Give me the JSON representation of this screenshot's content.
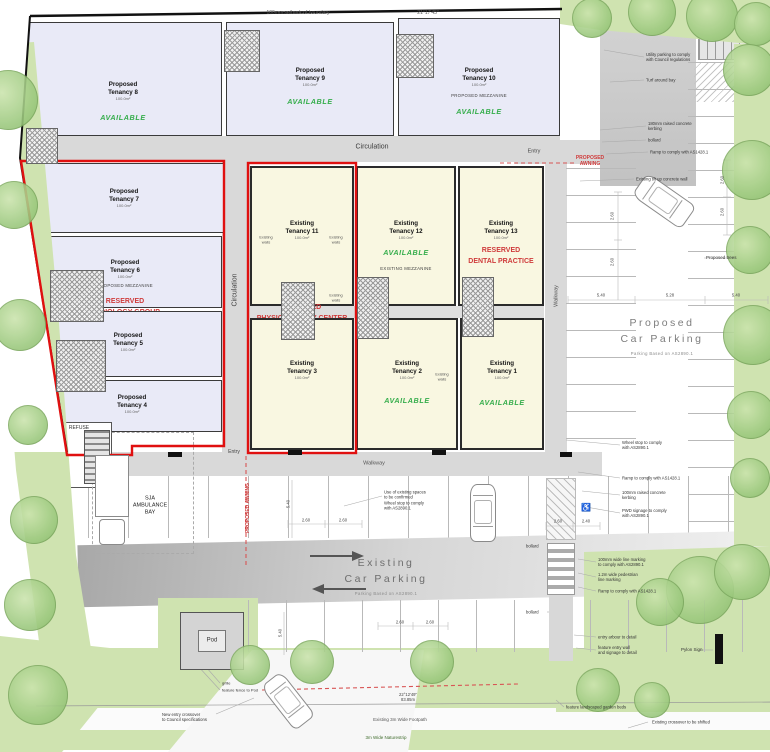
{
  "colors": {
    "proposed_room": "#e9eaf7",
    "existing_room": "#f9f7e1",
    "outline_red": "#e01010",
    "available_green": "#35ad4b",
    "reserved_red": "#cf3b3b",
    "landscape_green": "#cfe3b0"
  },
  "parking": {
    "existing": {
      "title": "Existing\nCar Parking",
      "subtitle": "Parking Based on AS2890.1"
    },
    "proposed": {
      "title": "Proposed\nCar Parking",
      "subtitle": "Parking Based on AS2890.1"
    }
  },
  "rooms": [
    {
      "id": "t8",
      "type": "proposed",
      "name": "Proposed\nTenancy 8",
      "area": "100.0m²",
      "status": "AVAILABLE",
      "box": [
        24,
        22,
        198,
        114
      ],
      "ty": {
        "name": 58,
        "area": 73,
        "status": 90
      }
    },
    {
      "id": "t9",
      "type": "proposed",
      "name": "Proposed\nTenancy 9",
      "area": "100.0m²",
      "status": "AVAILABLE",
      "box": [
        226,
        22,
        168,
        114
      ],
      "ty": {
        "name": 44,
        "area": 59,
        "status": 74
      }
    },
    {
      "id": "t10",
      "type": "proposed",
      "name": "Proposed\nTenancy 10",
      "area": "100.0m²",
      "note": "PROPOSED MEZZANINE",
      "status": "AVAILABLE",
      "box": [
        398,
        18,
        162,
        118
      ],
      "ty": {
        "name": 48,
        "area": 63,
        "note": 74,
        "status": 88
      }
    },
    {
      "id": "t7",
      "type": "proposed",
      "name": "Proposed\nTenancy 7",
      "area": "100.0m²",
      "box": [
        24,
        163,
        200,
        70
      ],
      "ty": {
        "name": 24,
        "area": 39
      }
    },
    {
      "id": "t6",
      "type": "proposed",
      "name": "Proposed\nTenancy 6",
      "area": "100.0m²",
      "note": "PROPOSED MEZZANINE",
      "reserved": "RESERVED\nRADIOLOGY GROUP",
      "box": [
        28,
        236,
        194,
        72
      ],
      "ty": {
        "name": 22,
        "area": 37,
        "note": 46,
        "reserved": 60
      }
    },
    {
      "id": "t5",
      "type": "proposed",
      "name": "Proposed\nTenancy 5",
      "area": "100.0m²",
      "box": [
        34,
        311,
        188,
        66
      ],
      "ty": {
        "name": 20,
        "area": 35
      }
    },
    {
      "id": "t4",
      "type": "proposed",
      "name": "Proposed\nTenancy 4",
      "area": "100.0m²",
      "box": [
        42,
        380,
        180,
        52
      ],
      "ty": {
        "name": 13,
        "area": 28
      }
    },
    {
      "id": "t11",
      "type": "existing",
      "name": "Existing\nTenancy 11",
      "area": "100.0m²",
      "reserved": "RESERVED\nPHYSIOTHERAPY CENTER",
      "box": [
        250,
        166,
        104,
        140
      ],
      "ty": {
        "name": 52,
        "area": 67,
        "reserved": 135
      }
    },
    {
      "id": "t12",
      "type": "existing",
      "name": "Existing\nTenancy 12",
      "area": "100.0m²",
      "status": "AVAILABLE",
      "note": "EXISTING MEZZANINE",
      "box": [
        356,
        166,
        100,
        140
      ],
      "ty": {
        "name": 52,
        "area": 67,
        "status": 80,
        "note": 98
      }
    },
    {
      "id": "t13",
      "type": "existing",
      "name": "Existing\nTenancy 13",
      "area": "100.0m²",
      "reserved": "RESERVED\nDENTAL PRACTICE",
      "box": [
        458,
        166,
        86,
        140
      ],
      "ty": {
        "name": 52,
        "area": 67,
        "reserved": 78
      }
    },
    {
      "id": "t3",
      "type": "existing",
      "name": "Existing\nTenancy 3",
      "area": "100.0m²",
      "box": [
        250,
        318,
        104,
        132
      ],
      "ty": {
        "name": 40,
        "area": 55
      }
    },
    {
      "id": "t2",
      "type": "existing",
      "name": "Existing\nTenancy 2",
      "area": "100.0m²",
      "status": "AVAILABLE",
      "box": [
        356,
        318,
        102,
        132
      ],
      "ty": {
        "name": 40,
        "area": 55,
        "status": 76
      }
    },
    {
      "id": "t1",
      "type": "existing",
      "name": "Existing\nTenancy 1",
      "area": "100.0m²",
      "status": "AVAILABLE",
      "box": [
        460,
        318,
        84,
        132
      ],
      "ty": {
        "name": 40,
        "area": 55,
        "status": 78
      }
    }
  ],
  "annotations": [
    {
      "id": "setback-note",
      "t": "100mm setback of boundary",
      "x": 298,
      "y": 13,
      "s": 5,
      "c": "#555"
    },
    {
      "id": "bearing-top",
      "t": "21°17'45\"",
      "x": 428,
      "y": 13,
      "s": 5,
      "c": "#555"
    },
    {
      "id": "circulation-top",
      "t": "Circulation",
      "x": 372,
      "y": 148,
      "s": 7,
      "c": "#3c3c3c"
    },
    {
      "id": "circulation-left",
      "t": "Circulation",
      "x": 236,
      "y": 290,
      "s": 7,
      "c": "#3c3c3c",
      "rot": -90
    },
    {
      "id": "walkway-right",
      "t": "Walkway",
      "x": 557,
      "y": 296,
      "s": 5.5,
      "c": "#555",
      "rot": -90
    },
    {
      "id": "walkway-bottom",
      "t": "Walkway",
      "x": 374,
      "y": 464,
      "s": 5.5,
      "c": "#555"
    },
    {
      "id": "entry-top",
      "t": "Entry",
      "x": 534,
      "y": 152,
      "s": 5.5,
      "c": "#444"
    },
    {
      "id": "entry-bottom",
      "t": "Entry",
      "x": 234,
      "y": 452,
      "s": 5,
      "c": "#444"
    },
    {
      "id": "proposed-awning-right",
      "t": "PROPOSED\nAWNING",
      "x": 590,
      "y": 161,
      "s": 5,
      "c": "#cf3b3b",
      "b": 1
    },
    {
      "id": "proposed-awning-mid",
      "t": "PROPOSED AWNING",
      "x": 248,
      "y": 508,
      "s": 5,
      "c": "#cf3b3b",
      "rot": -90,
      "b": 1
    },
    {
      "id": "ambulance-bay-label",
      "t": "SJA\nAMBULANCE\nBAY",
      "x": 150,
      "y": 506,
      "s": 5.5,
      "c": "#222"
    },
    {
      "id": "refuse-label",
      "t": "REFUSE",
      "x": 79,
      "y": 428,
      "s": 5,
      "c": "#333"
    },
    {
      "id": "existing-spaces-note",
      "t": "Use of existing spaces\nto be confirmed\nWheel stop to comply\nwith AS2890.1",
      "x": 384,
      "y": 500,
      "s": 4.2,
      "a": "l"
    },
    {
      "id": "proposed-trees-note",
      "t": "Proposed trees",
      "x": 706,
      "y": 258,
      "s": 4.5,
      "a": "l"
    },
    {
      "id": "utility-parking-note",
      "t": "Utility parking to comply\nwith Council regulations",
      "x": 646,
      "y": 57,
      "s": 4.2,
      "a": "l"
    },
    {
      "id": "turf-note",
      "t": "Turf around bay",
      "x": 646,
      "y": 80,
      "s": 4.2,
      "a": "l"
    },
    {
      "id": "kerbing-note-1",
      "t": "180mm raised concrete\nkerbing",
      "x": 648,
      "y": 126,
      "s": 4.2,
      "a": "l"
    },
    {
      "id": "bollard-note-1",
      "t": "bollard",
      "x": 648,
      "y": 140,
      "s": 4.2,
      "a": "l"
    },
    {
      "id": "ramp-note-1",
      "t": "Ramp to comply with AS1428.1",
      "x": 650,
      "y": 152,
      "s": 4.2,
      "a": "l"
    },
    {
      "id": "tiltup-wall-note",
      "t": "Existing tilt up concrete wall",
      "x": 636,
      "y": 179,
      "s": 4.2,
      "a": "l"
    },
    {
      "id": "wheelstop-note",
      "t": "Wheel stop to comply\nwith AS2890.1",
      "x": 622,
      "y": 445,
      "s": 4.2,
      "a": "l"
    },
    {
      "id": "ramp-note-2",
      "t": "Ramp to comply with AS1428.1",
      "x": 622,
      "y": 478,
      "s": 4.2,
      "a": "l"
    },
    {
      "id": "kerbing-note-2",
      "t": "100mm raised concrete\nkerbing",
      "x": 622,
      "y": 495,
      "s": 4.2,
      "a": "l"
    },
    {
      "id": "pwd-signage-note",
      "t": "PWD signage to comply\nwith AS2890.1",
      "x": 622,
      "y": 513,
      "s": 4.2,
      "a": "l"
    },
    {
      "id": "line-marking-note",
      "t": "100mm wide line marking\nto comply with AS2890.1",
      "x": 598,
      "y": 562,
      "s": 4.2,
      "a": "l"
    },
    {
      "id": "pedestrian-marking-note",
      "t": "1.2m wide pedestrian\nline marking",
      "x": 598,
      "y": 577,
      "s": 4.2,
      "a": "l"
    },
    {
      "id": "ramp-note-3",
      "t": "Ramp to comply with AS1428.1",
      "x": 598,
      "y": 591,
      "s": 4.2,
      "a": "l"
    },
    {
      "id": "bollard-note-2",
      "t": "bollard",
      "x": 526,
      "y": 546,
      "s": 4.2,
      "a": "l"
    },
    {
      "id": "bollard-note-3",
      "t": "bollard",
      "x": 526,
      "y": 612,
      "s": 4.2,
      "a": "l"
    },
    {
      "id": "entry-arbour-note",
      "t": "entry arbour to detail",
      "x": 598,
      "y": 637,
      "s": 4.2,
      "a": "l"
    },
    {
      "id": "entry-wall-note",
      "t": "feature entry wall\nand signage to detail",
      "x": 598,
      "y": 650,
      "s": 4.2,
      "a": "l"
    },
    {
      "id": "pylon-sign-label",
      "t": "Pylon Sign",
      "x": 681,
      "y": 650,
      "s": 4.5,
      "a": "l"
    },
    {
      "id": "garden-beds-note",
      "t": "feature landscaped garden beds",
      "x": 566,
      "y": 707,
      "s": 4.2,
      "a": "l"
    },
    {
      "id": "crossover-shift-note",
      "t": "Existing crossover to be shifted",
      "x": 652,
      "y": 722,
      "s": 4.2,
      "a": "l"
    },
    {
      "id": "pod-label",
      "t": "Pod",
      "x": 212,
      "y": 641,
      "s": 6,
      "c": "#333"
    },
    {
      "id": "grille-label",
      "t": "grille",
      "x": 222,
      "y": 683,
      "s": 4,
      "a": "l"
    },
    {
      "id": "pod-fence-label",
      "t": "feature fence to Pod",
      "x": 222,
      "y": 690,
      "s": 4,
      "a": "l"
    },
    {
      "id": "bearing-bottom",
      "t": "22°12'49\"\n83.85m",
      "x": 408,
      "y": 697,
      "s": 4.2,
      "c": "#444"
    },
    {
      "id": "footpath-label",
      "t": "Existing 3m Wide Footpath",
      "x": 400,
      "y": 720,
      "s": 4.5,
      "c": "#555"
    },
    {
      "id": "naturestrip-label",
      "t": "3m Wide Naturestrip",
      "x": 386,
      "y": 738,
      "s": 4.5,
      "c": "#3f6b2c"
    },
    {
      "id": "new-crossover-note",
      "t": "New entry crossover\nto Council specifications",
      "x": 162,
      "y": 717,
      "s": 4.2,
      "a": "l"
    },
    {
      "id": "existing-walls-1",
      "t": "Existing\nwalls",
      "x": 266,
      "y": 240,
      "s": 3.8,
      "c": "#555"
    },
    {
      "id": "existing-walls-2",
      "t": "Existing\nwalls",
      "x": 336,
      "y": 240,
      "s": 3.8,
      "c": "#555"
    },
    {
      "id": "existing-walls-3",
      "t": "Existing\nwalls",
      "x": 336,
      "y": 298,
      "s": 3.8,
      "c": "#555"
    },
    {
      "id": "existing-walls-4",
      "t": "Existing\nwalls",
      "x": 442,
      "y": 377,
      "s": 3.8,
      "c": "#555"
    },
    {
      "id": "wheelchair-symbol",
      "t": "♿",
      "x": 586,
      "y": 508,
      "s": 8,
      "c": "#777"
    },
    {
      "id": "dim-1",
      "t": "2.60",
      "x": 306,
      "y": 520,
      "s": 4.2,
      "c": "#444"
    },
    {
      "id": "dim-2",
      "t": "2.60",
      "x": 343,
      "y": 520,
      "s": 4.2,
      "c": "#444"
    },
    {
      "id": "dim-3",
      "t": "2.60",
      "x": 558,
      "y": 521,
      "s": 4.2,
      "c": "#444"
    },
    {
      "id": "dim-4",
      "t": "2.40",
      "x": 586,
      "y": 521,
      "s": 4.2,
      "c": "#444"
    },
    {
      "id": "dim-5",
      "t": "2.60",
      "x": 400,
      "y": 622,
      "s": 4.2,
      "c": "#444"
    },
    {
      "id": "dim-6",
      "t": "2.60",
      "x": 430,
      "y": 622,
      "s": 4.2,
      "c": "#444"
    },
    {
      "id": "dim-7",
      "t": "5.40",
      "x": 601,
      "y": 295,
      "s": 4.2,
      "c": "#444"
    },
    {
      "id": "dim-8",
      "t": "5.28",
      "x": 670,
      "y": 295,
      "s": 4.2,
      "c": "#444"
    },
    {
      "id": "dim-9",
      "t": "5.40",
      "x": 736,
      "y": 295,
      "s": 4.2,
      "c": "#444"
    },
    {
      "id": "dim-10",
      "t": "2.60",
      "x": 612,
      "y": 216,
      "s": 4.2,
      "c": "#444",
      "rot": -90
    },
    {
      "id": "dim-11",
      "t": "2.60",
      "x": 612,
      "y": 262,
      "s": 4.2,
      "c": "#444",
      "rot": -90
    },
    {
      "id": "dim-12",
      "t": "2.60",
      "x": 722,
      "y": 180,
      "s": 4.2,
      "c": "#444",
      "rot": -90
    },
    {
      "id": "dim-13",
      "t": "2.60",
      "x": 722,
      "y": 212,
      "s": 4.2,
      "c": "#444",
      "rot": -90
    },
    {
      "id": "dim-14",
      "t": "5.40",
      "x": 288,
      "y": 504,
      "s": 4.2,
      "c": "#444",
      "rot": -90
    },
    {
      "id": "dim-15",
      "t": "5.40",
      "x": 280,
      "y": 633,
      "s": 4.2,
      "c": "#444",
      "rot": -90
    }
  ],
  "trees": [
    [
      8,
      100,
      30
    ],
    [
      14,
      205,
      24
    ],
    [
      20,
      325,
      26
    ],
    [
      28,
      425,
      20
    ],
    [
      34,
      520,
      24
    ],
    [
      30,
      605,
      26
    ],
    [
      38,
      695,
      30
    ],
    [
      592,
      18,
      20
    ],
    [
      652,
      12,
      24
    ],
    [
      712,
      16,
      26
    ],
    [
      756,
      24,
      22
    ],
    [
      749,
      70,
      26
    ],
    [
      752,
      170,
      30
    ],
    [
      750,
      250,
      24
    ],
    [
      753,
      335,
      30
    ],
    [
      751,
      415,
      24
    ],
    [
      750,
      478,
      20
    ],
    [
      250,
      665,
      20
    ],
    [
      312,
      662,
      22
    ],
    [
      432,
      662,
      22
    ],
    [
      700,
      590,
      34
    ],
    [
      742,
      572,
      28
    ],
    [
      660,
      602,
      24
    ],
    [
      598,
      690,
      22
    ],
    [
      652,
      700,
      18
    ]
  ],
  "cores": [
    [
      224,
      30,
      36,
      42
    ],
    [
      396,
      34,
      38,
      44
    ],
    [
      26,
      128,
      32,
      36
    ],
    [
      50,
      270,
      54,
      52
    ],
    [
      56,
      340,
      50,
      52
    ],
    [
      281,
      282,
      34,
      58
    ],
    [
      357,
      277,
      32,
      62
    ],
    [
      462,
      277,
      32,
      60
    ]
  ],
  "cars": [
    {
      "cx": 663,
      "cy": 200,
      "w": 26,
      "h": 58,
      "rot": -55
    },
    {
      "cx": 482,
      "cy": 512,
      "w": 24,
      "h": 56,
      "rot": 0
    },
    {
      "cx": 287,
      "cy": 700,
      "w": 24,
      "h": 54,
      "rot": -38
    }
  ]
}
